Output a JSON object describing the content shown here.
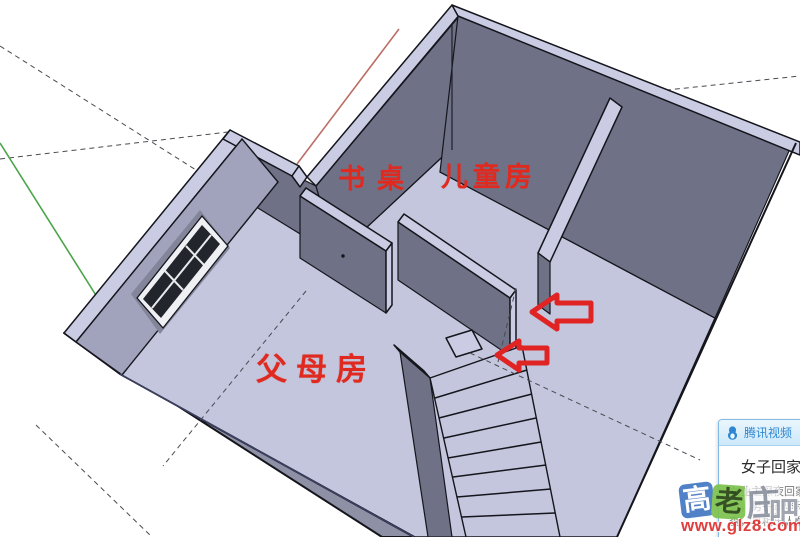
{
  "labels": {
    "desk": "书桌",
    "kids_room": "儿童房",
    "parents_room": "父母房"
  },
  "popup": {
    "app_name": "腾讯视频",
    "title": "女子回家",
    "body_lines": [
      "女业主深夜回家",
      "觉，男子却坚称",
      "查，真相出人意"
    ]
  },
  "watermark": {
    "glyphs": [
      "高",
      "老",
      "庄",
      "吧"
    ],
    "url": "www.glz8.com"
  },
  "colors": {
    "label_red": "#e02a20",
    "arrow_red": "#e02424",
    "floor": "#c3c6dd",
    "wall_dark": "#6f7287",
    "ridge": "#c9cce3",
    "slab": "#8e91a6",
    "outline": "#15151c",
    "axis_green": "#4aa54a",
    "axis_red": "#bc6e66",
    "popup_blue": "#2e86d2",
    "watermark_red": "#e03030"
  }
}
